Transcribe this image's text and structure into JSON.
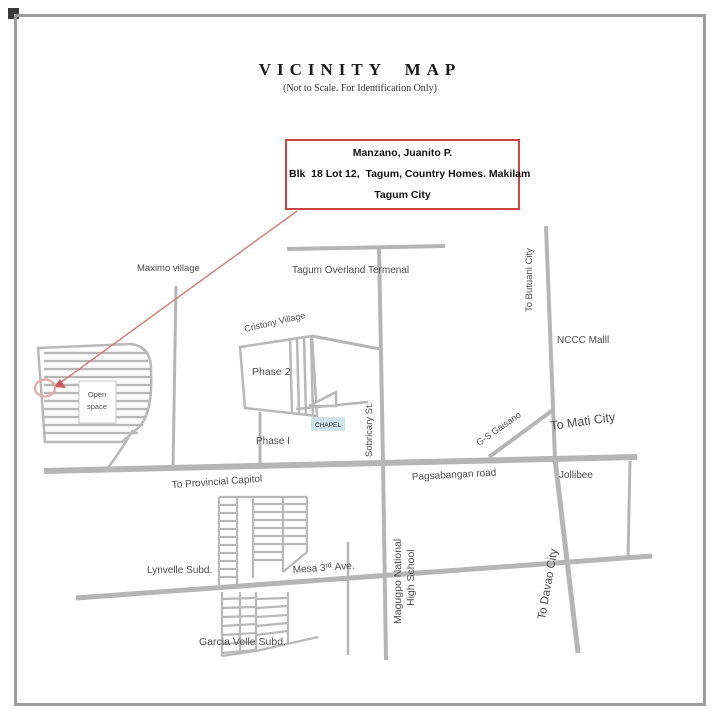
{
  "header": {
    "title": "VICINITY MAP",
    "subtitle": "(Not to Scale. For Identification Only)"
  },
  "address_box": {
    "line1": "Manzano, Juanito P.",
    "line2": "Blk  18 Lot 12,  Tagum, Country Homes. Makilam",
    "line3": "Tagum City"
  },
  "map": {
    "labels": {
      "maximo_village": "Maximo village",
      "tagum_overland_terminal": "Tagum Overland Termenal",
      "cristony_village": "Cristony Village",
      "phase_2": "Phase 2",
      "phase_1": "Phase I",
      "open_space_1": "Open",
      "open_space_2": "space",
      "chapel": "CHAPEL",
      "sobricary_st": "Sobricary St.",
      "magugpo_1": "Magugpo National",
      "magugpo_2": "High School",
      "to_butuan_city": "To Butuani City",
      "nccc_mall": "NCCC Malll",
      "gs_gaisano": "G-S Gaisano",
      "to_mati_city": "To Mati City",
      "to_provincial_capitol": "To Provincial Capitol",
      "pagsabangan_road": "Pagsabangan road",
      "jollibee": "Jollibee",
      "to_davao_city": "To Davao City",
      "lynvelle_subd": "Lynvelle Subd.",
      "mesa_ave_pre": "Mesa 3",
      "mesa_ave_sup": "rd",
      "mesa_ave_post": "Ave.",
      "garcia_velle_subd": "Garcia Velle Subd."
    },
    "colors": {
      "road_gray": "#b5b5b5",
      "red_accent": "#cc4646",
      "red_line": "#d07a7a",
      "red_circle": "#e2a9a9",
      "chapel_highlight": "#cfe3ea",
      "label_text": "#4c4c4c",
      "frame_border": "#9c9c9c"
    }
  }
}
